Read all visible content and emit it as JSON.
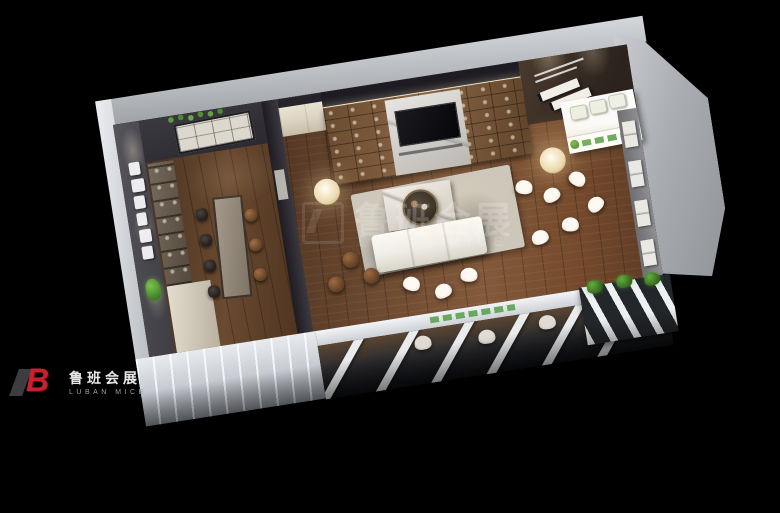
{
  "watermark": {
    "cn": "鲁班会展",
    "en": "LUBAN MICE"
  },
  "brand": {
    "monogram_l": "",
    "monogram_b": "B",
    "name_cn": "鲁班会展",
    "name_en": "LUBAN MICE"
  },
  "colors": {
    "background": "#000000",
    "brand_red": "#c8202f",
    "brand_green": "#56a83c",
    "exterior_gray": "#a9acb1",
    "wood_floor": "#74492c"
  }
}
